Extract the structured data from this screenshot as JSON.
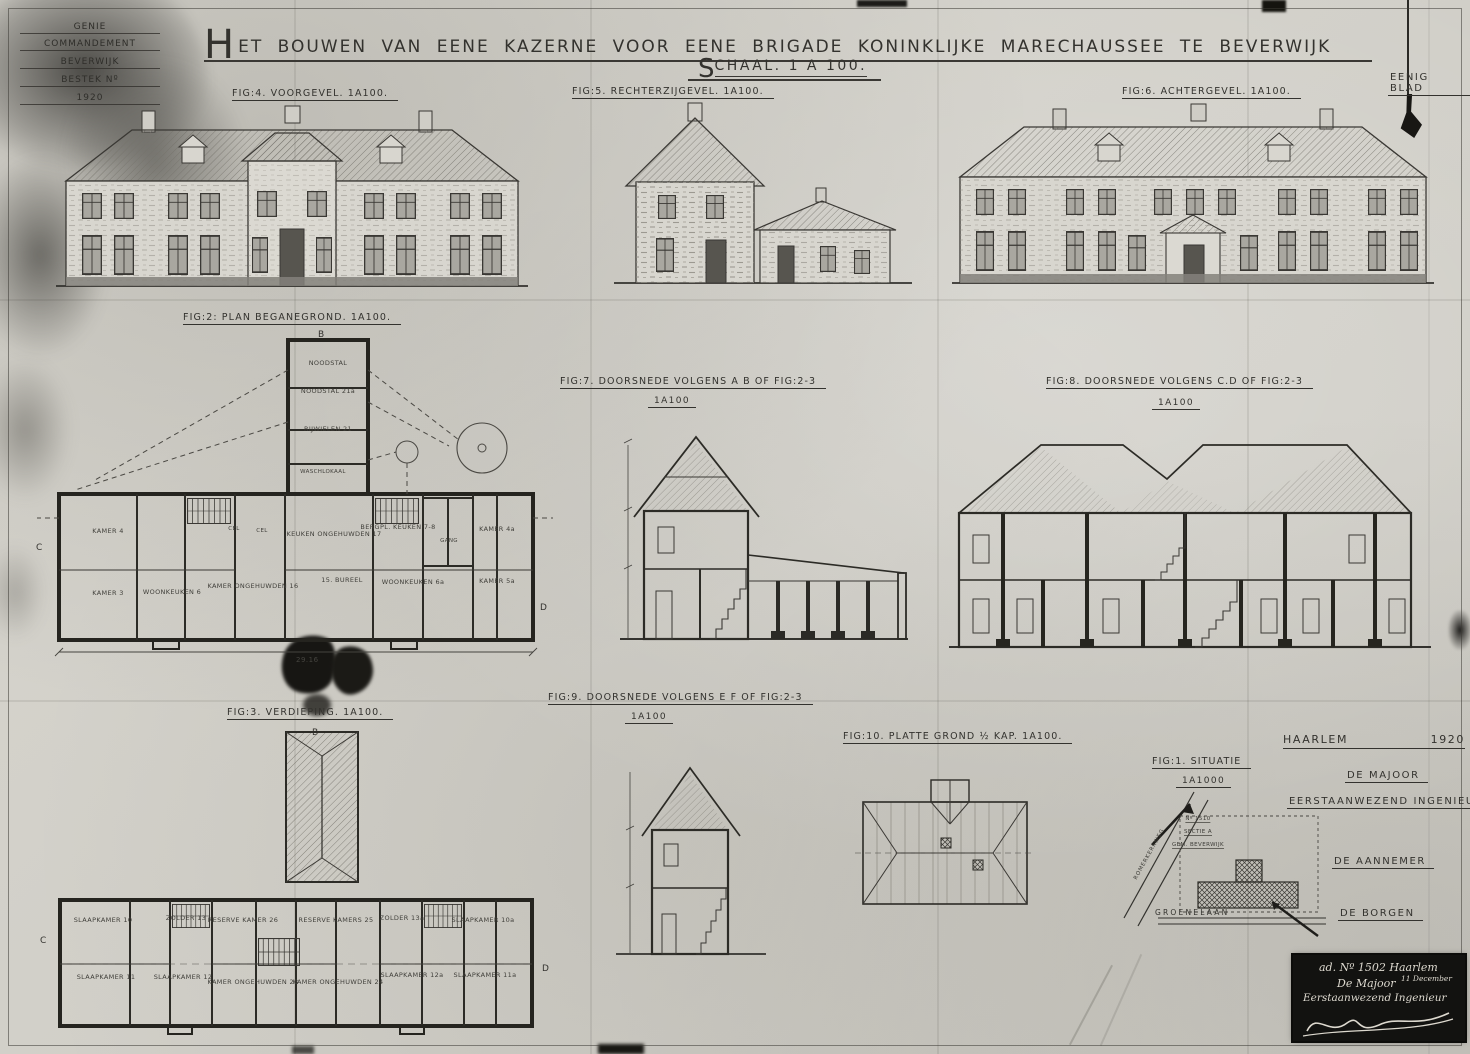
{
  "colors": {
    "paper": "#d6d4cd",
    "ink": "#33322e",
    "stamp_bg": "#121210",
    "stamp_text": "#ddd9cf"
  },
  "corner_stamp": {
    "line1": "GENIE",
    "line2": "COMMANDEMENT",
    "line3": "BEVERWIJK",
    "line4": "BESTEK Nº",
    "line5": "1920"
  },
  "title": {
    "first": "H",
    "rest": "ET BOUWEN VAN EENE KAZERNE VOOR EENE BRIGADE KONINKLIJKE MARECHAUSSEE TE BEVERWIJK",
    "scale_first": "S",
    "scale_rest": "CHAAL. 1 A 100.",
    "sheet_note": "EENIG BLAD"
  },
  "figures": {
    "fig4": {
      "caption": "FIG:4. VOORGEVEL. 1A100."
    },
    "fig5": {
      "caption": "FIG:5. RECHTERZIJGEVEL. 1A100."
    },
    "fig6": {
      "caption": "FIG:6. ACHTERGEVEL. 1A100."
    },
    "fig2": {
      "caption": "FIG:2: PLAN BEGANEGROND. 1A100.",
      "dim": "29.16",
      "rooms": [
        "KAMER 4",
        "KAMER 3",
        "WOONKEUKEN 6",
        "KAMER ONGEHUWDEN 16",
        "KEUKEN ONGEHUWDEN 17",
        "BERGPL. KEUKEN 7-8",
        "KAMER 4a",
        "15. BUREEL",
        "WOONKEUKEN 6a",
        "KAMER 5a",
        "CEL",
        "CEL",
        "GANG",
        "NOODSTAL",
        "NOODSTAL 21a",
        "RIJWIELEN 21",
        "WASCHLOKAAL"
      ]
    },
    "fig7": {
      "caption": "FIG:7. DOORSNEDE VOLGENS A B OF FIG:2-3",
      "scale": "1A100"
    },
    "fig8": {
      "caption": "FIG:8. DOORSNEDE VOLGENS C.D OF FIG:2-3",
      "scale": "1A100"
    },
    "fig3": {
      "caption": "FIG:3. VERDIEPING. 1A100.",
      "rooms": [
        "SLAAPKAMER 10",
        "ZOLDER 13",
        "RESERVE KAMER 26",
        "RESERVE KAMERS 25",
        "ZOLDER 13a",
        "SLAAPKAMER 10a",
        "SLAAPKAMER 11",
        "SLAAPKAMER 12",
        "KAMER ONGEHUWDEN 23",
        "KAMER ONGEHUWDEN 24",
        "SLAAPKAMER 12a",
        "SLAAPKAMER 11a"
      ]
    },
    "fig9": {
      "caption": "FIG:9. DOORSNEDE VOLGENS E F OF FIG:2-3",
      "scale": "1A100"
    },
    "fig10": {
      "caption": "FIG:10. PLATTE GROND ½ KAP. 1A100."
    },
    "fig1": {
      "caption": "FIG:1. SITUATIE",
      "scale": "1A1000",
      "parcel_no": "Nº 1510",
      "parcel_sectie": "SECTIE A",
      "parcel_gem": "GEM. BEVERWIJK",
      "street_diag": "ROMERKERKWEG",
      "street_bottom": "GROENELAAN"
    }
  },
  "markers": {
    "b": "B",
    "c": "C",
    "d": "D"
  },
  "signatures": {
    "place": "HAARLEM",
    "year": "1920",
    "majoor1": "DE MAJOOR",
    "majoor2": "EERSTAANWEZEND INGENIEUR",
    "aannemer": "DE AANNEMER",
    "borgen": "DE BORGEN"
  },
  "stamp": {
    "line1": "ad. Nº 1502 Haarlem",
    "line2": "11 December",
    "line3": "De Majoor",
    "line4": "Eerstaanwezend Ingenieur"
  }
}
